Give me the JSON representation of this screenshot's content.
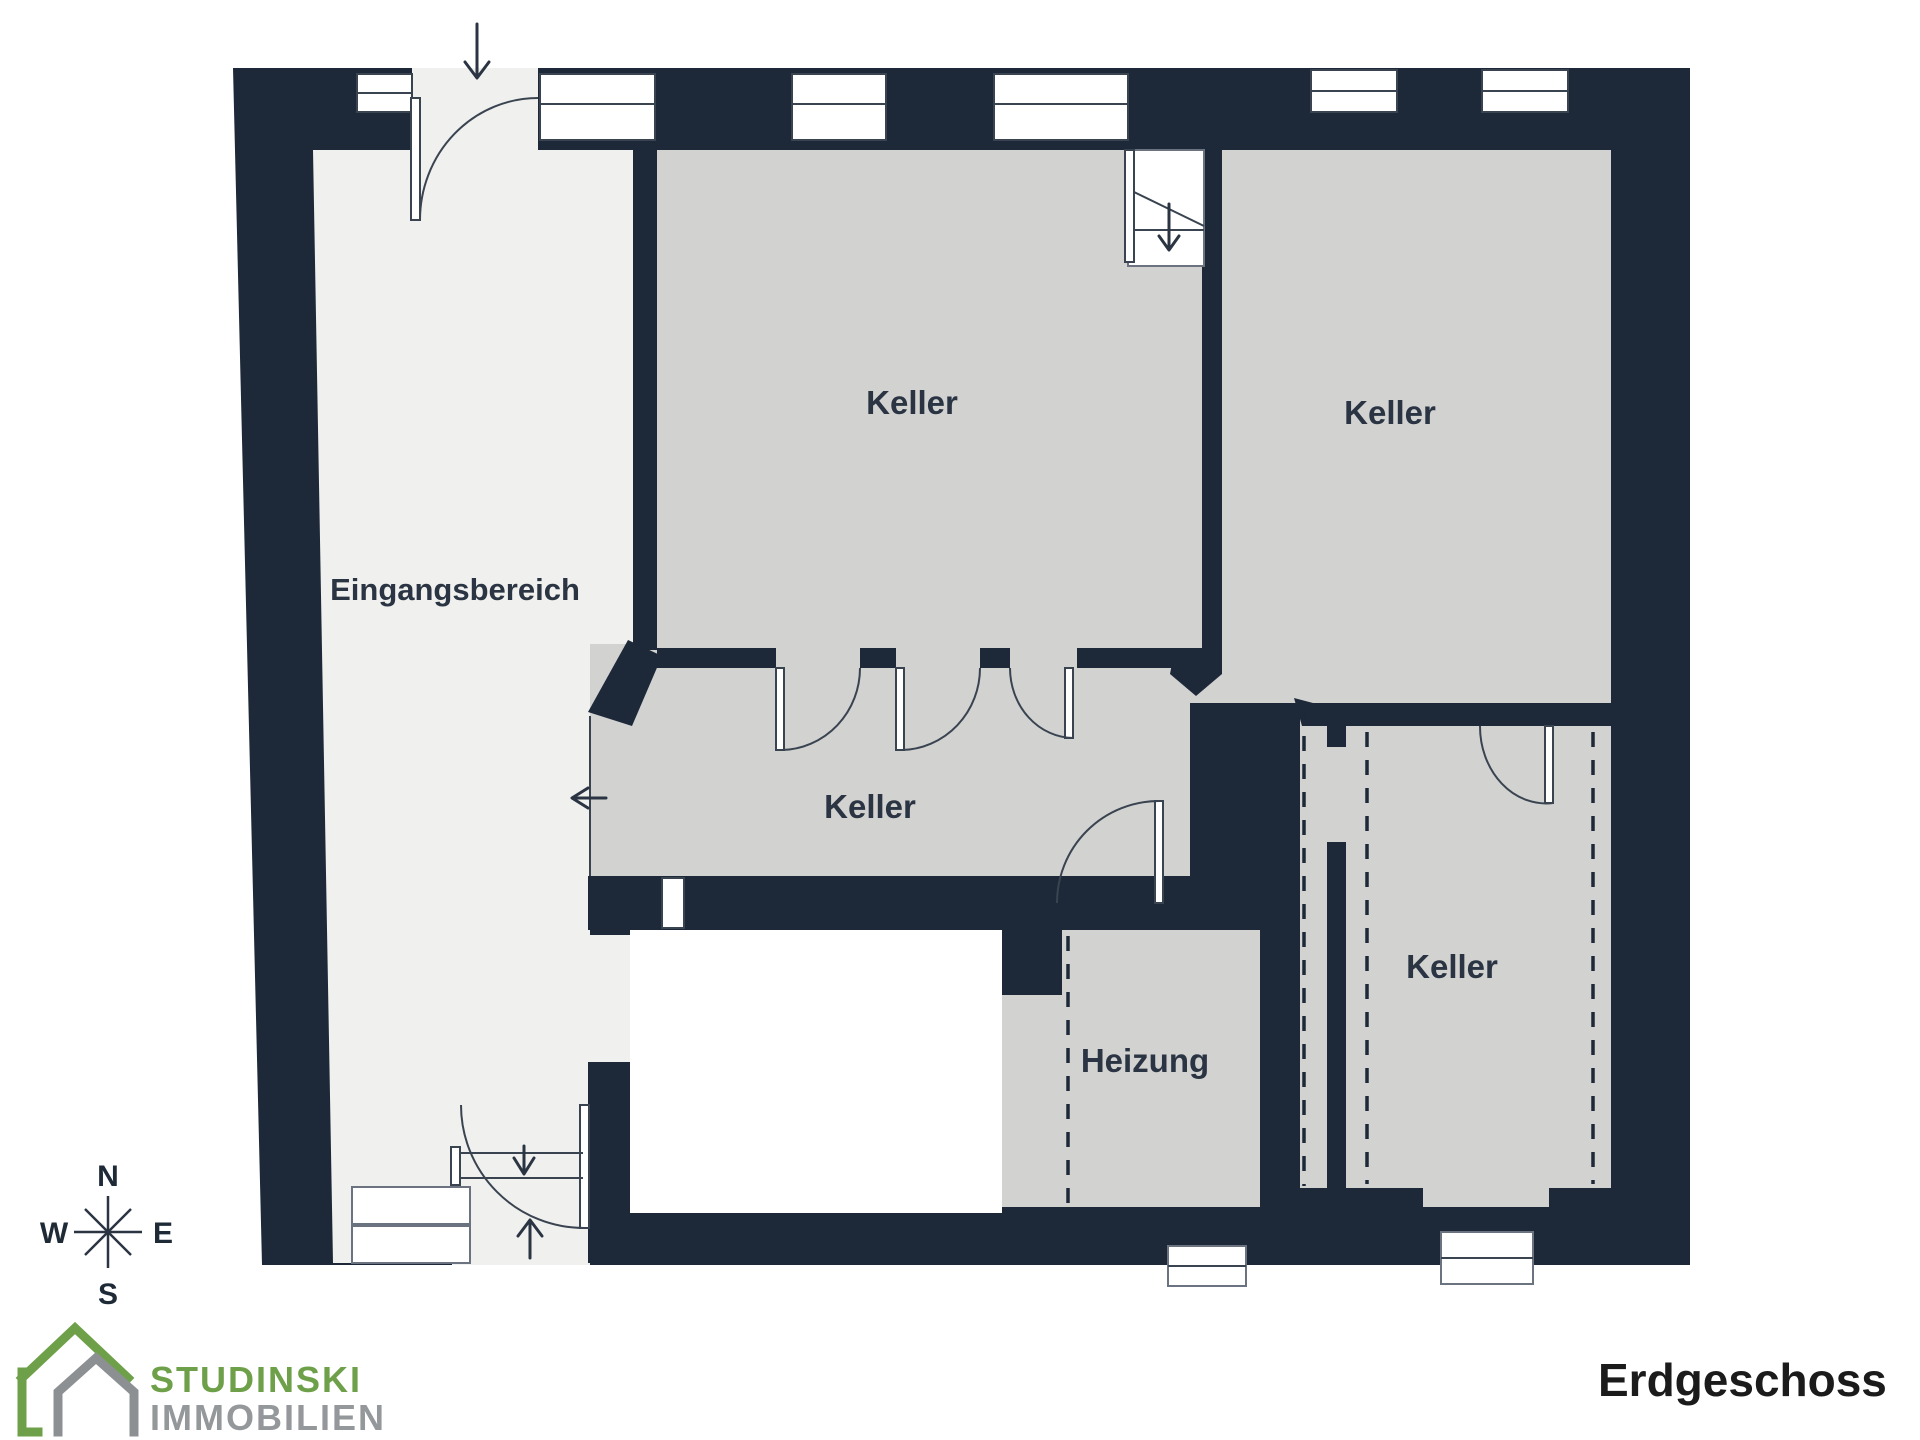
{
  "title": {
    "text": "Erdgeschoss"
  },
  "brand": {
    "name": "STUDINSKI",
    "division": "IMMOBILIEN",
    "green": "#6ea049",
    "gray": "#95989a"
  },
  "compass": {
    "north": "N",
    "east": "E",
    "south": "S",
    "west": "W"
  },
  "floorplan": {
    "colors": {
      "wall": "#1d2939",
      "room": "#d2d2d1",
      "entrance_room": "#f0f0ee",
      "outline": "#3a4450",
      "background": "#ffffff"
    },
    "rooms": [
      {
        "id": "eingangsbereich",
        "label": "Eingangsbereich"
      },
      {
        "id": "keller-top-left",
        "label": "Keller"
      },
      {
        "id": "keller-top-right",
        "label": "Keller"
      },
      {
        "id": "keller-corridor",
        "label": "Keller"
      },
      {
        "id": "heizung",
        "label": "Heizung"
      },
      {
        "id": "keller-bottom-right",
        "label": "Keller"
      }
    ]
  }
}
